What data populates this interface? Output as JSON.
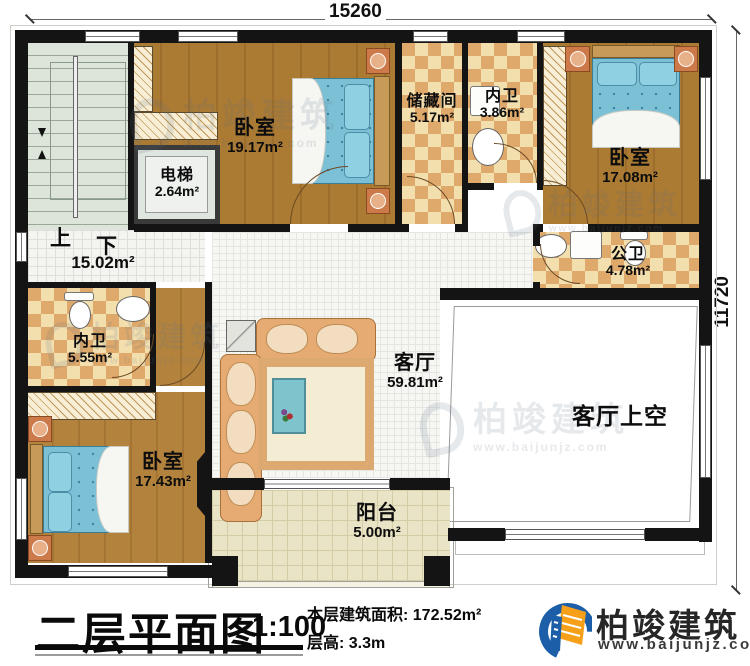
{
  "dimensions": {
    "top": "15260",
    "right": "11720"
  },
  "stairs": {
    "up": "上",
    "down": "下",
    "area": "15.02m²"
  },
  "rooms": {
    "bedroom_tl": {
      "name": "卧室",
      "area": "19.17m²"
    },
    "elevator": {
      "name": "电梯",
      "area": "2.64m²"
    },
    "storage": {
      "name": "储藏间",
      "area": "5.17m²"
    },
    "bath_top": {
      "name": "内卫",
      "area": "3.86m²"
    },
    "bedroom_tr": {
      "name": "卧室",
      "area": "17.08m²"
    },
    "bath_public": {
      "name": "公卫",
      "area": "4.78m²"
    },
    "bath_left": {
      "name": "内卫",
      "area": "5.55m²"
    },
    "bedroom_bl": {
      "name": "卧室",
      "area": "17.43m²"
    },
    "living": {
      "name": "客厅",
      "area": "59.81m²"
    },
    "living_void": {
      "name": "客厅上空"
    },
    "balcony": {
      "name": "阳台",
      "area": "5.00m²"
    }
  },
  "titleblock": {
    "title": "二层平面图",
    "scale": "1:100",
    "area_text": "本层建筑面积: 172.52m²",
    "height_text": "层高: 3.3m"
  },
  "branding": {
    "name": "柏竣建筑",
    "website": "www.baijunjz.com"
  },
  "watermark": {
    "name": "柏竣建筑",
    "website": "www.baijunjz.com"
  }
}
